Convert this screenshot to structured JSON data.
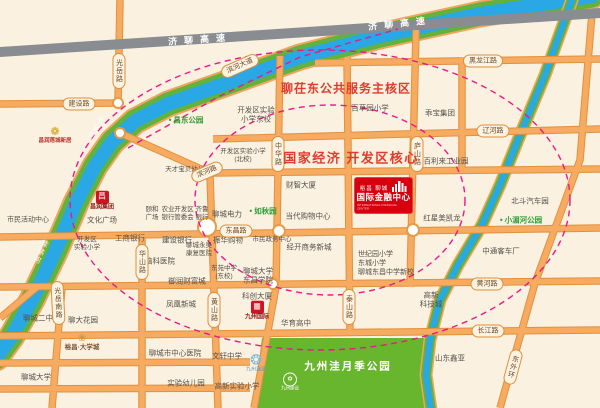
{
  "map": {
    "colors": {
      "background": "#faf1e0",
      "accent_red": "#e23a2c",
      "brand_red": "#d6000f",
      "road_orange": "#f6ab60",
      "river_blue": "#2aa7e5",
      "bank_green": "#62b23b",
      "park_green": "#68b52e",
      "dash_pink": "#ea1889",
      "highway_gray": "#898c90"
    },
    "highway_labels": [
      {
        "name": "jiliao-expressway-label-west",
        "text": "济聊高速",
        "x": 200,
        "y": 39,
        "r": -4
      },
      {
        "name": "jiliao-expressway-label-east",
        "text": "济聊高速",
        "x": 400,
        "y": 23,
        "r": -6
      }
    ],
    "zone_labels": [
      {
        "name": "zone-label-liaochidong",
        "text": "聊茌东公共服务主核区",
        "x": 346,
        "y": 88,
        "fs": 12,
        "ls": 1
      },
      {
        "name": "zone-label-kaifaqu-core",
        "text": "国家经济 开发区核心",
        "x": 351,
        "y": 157,
        "fs": 13,
        "ls": 1.5
      }
    ],
    "river_names": [
      {
        "name": "tuhai-river-label-1",
        "text": "徒骇河",
        "x": 95,
        "y": 128,
        "r": 30
      },
      {
        "name": "tuhai-river-label-2",
        "text": "徒骇河",
        "x": 40,
        "y": 252,
        "r": 25
      },
      {
        "name": "xiaomei-river-label",
        "text": "小湄河",
        "x": 452,
        "y": 248,
        "r": 26
      }
    ],
    "road_badges": [
      {
        "name": "badge-jianshe-road",
        "text": "建设路",
        "x": 79,
        "y": 104,
        "v": false,
        "r": 0
      },
      {
        "name": "badge-guangyue-road",
        "text": "光岳路",
        "x": 119,
        "y": 71,
        "v": true,
        "r": 0
      },
      {
        "name": "badge-binhe-avenue",
        "text": "滨河大道",
        "x": 240,
        "y": 66,
        "v": false,
        "r": -24
      },
      {
        "name": "badge-heilongjiang-road",
        "text": "黑龙江路",
        "x": 483,
        "y": 61,
        "v": false,
        "r": 0
      },
      {
        "name": "badge-liaohe-road",
        "text": "辽河路",
        "x": 493,
        "y": 131,
        "v": false,
        "r": 0
      },
      {
        "name": "badge-binhe-road",
        "text": "滨河路",
        "x": 207,
        "y": 172,
        "v": false,
        "r": -23
      },
      {
        "name": "badge-zhonghua-road",
        "text": "中华路",
        "x": 278,
        "y": 154,
        "v": true,
        "r": 0
      },
      {
        "name": "badge-lushan-road",
        "text": "庐山路",
        "x": 417,
        "y": 154,
        "v": true,
        "r": 0
      },
      {
        "name": "badge-dongchang-road",
        "text": "东昌路",
        "x": 236,
        "y": 231,
        "v": false,
        "r": 0
      },
      {
        "name": "badge-huashan-road",
        "text": "华山路",
        "x": 142,
        "y": 262,
        "v": true,
        "r": 0
      },
      {
        "name": "badge-huangshan-road",
        "text": "黄山路",
        "x": 214,
        "y": 310,
        "v": true,
        "r": 0
      },
      {
        "name": "badge-taishan-road",
        "text": "泰山路",
        "x": 349,
        "y": 307,
        "v": true,
        "r": 0
      },
      {
        "name": "badge-guangyue-south-road",
        "text": "光岳南路",
        "x": 58,
        "y": 303,
        "v": true,
        "r": -3
      },
      {
        "name": "badge-huanghe-road",
        "text": "黄河路",
        "x": 487,
        "y": 284,
        "v": false,
        "r": 0
      },
      {
        "name": "badge-changjiang-road",
        "text": "长江路",
        "x": 488,
        "y": 331,
        "v": false,
        "r": 0
      },
      {
        "name": "badge-dongwaihuan-road",
        "text": "东外环",
        "x": 513,
        "y": 367,
        "v": true,
        "r": 15
      }
    ],
    "green_pois": [
      {
        "name": "changdong-park-label",
        "text": "昌东公园",
        "x": 186,
        "y": 120
      },
      {
        "name": "ruqiu-garden-label",
        "text": "如秋园",
        "x": 263,
        "y": 211
      },
      {
        "name": "xiaomeihe-park-label",
        "text": "小湄河公园",
        "x": 521,
        "y": 220
      }
    ],
    "poi_labels": [
      {
        "name": "kaifaqu-exp-primary-east",
        "text": "开发区实验\n小学东校",
        "x": 256,
        "y": 115
      },
      {
        "name": "kaifaqu-exp-primary-north",
        "text": "开发区实验小学\n(北校)",
        "x": 243,
        "y": 156,
        "fs": 6.5
      },
      {
        "name": "tiancai-baby-kindergarten",
        "text": "天才宝贝幼儿园",
        "x": 188,
        "y": 170,
        "fs": 6.5
      },
      {
        "name": "baicaoyuan-primary",
        "text": "百草园小学",
        "x": 370,
        "y": 108
      },
      {
        "name": "guaibao-group",
        "text": "乖宝集团",
        "x": 440,
        "y": 113
      },
      {
        "name": "baililai-industrial-park",
        "text": "百利来工业园",
        "x": 446,
        "y": 161
      },
      {
        "name": "beidou-auto-park",
        "text": "北斗汽车园",
        "x": 530,
        "y": 201
      },
      {
        "name": "zhongtong-bus-factory",
        "text": "中通客车厂",
        "x": 501,
        "y": 251
      },
      {
        "name": "hongxing-meikailong",
        "text": "红星美凯龙",
        "x": 442,
        "y": 218
      },
      {
        "name": "caizhi-tower",
        "text": "财智大厦",
        "x": 301,
        "y": 185
      },
      {
        "name": "liaocheng-power",
        "text": "聊城电力",
        "x": 227,
        "y": 214
      },
      {
        "name": "dangdai-shopping-center",
        "text": "当代购物中心",
        "x": 308,
        "y": 216
      },
      {
        "name": "yihe-plaza",
        "text": "颐和\n广场",
        "x": 152,
        "y": 214,
        "fs": 6.5
      },
      {
        "name": "agricultural-bank",
        "text": "农业\n银行",
        "x": 168,
        "y": 214,
        "fs": 6.5
      },
      {
        "name": "kaifaqu-committee",
        "text": "开发区\n管委会",
        "x": 184,
        "y": 214,
        "fs": 6.5
      },
      {
        "name": "qilu-bank",
        "text": "齐鲁\n银行",
        "x": 202,
        "y": 214,
        "fs": 6.5
      },
      {
        "name": "icbc-bank",
        "text": "工商银行",
        "x": 130,
        "y": 238
      },
      {
        "name": "ccb-bank",
        "text": "建设银行",
        "x": 177,
        "y": 240
      },
      {
        "name": "zhenhua-shopping",
        "text": "振华购物",
        "x": 228,
        "y": 240
      },
      {
        "name": "civic-affairs-center",
        "text": "市民政务中心",
        "x": 272,
        "y": 240,
        "fs": 6.5
      },
      {
        "name": "jingkai-business-newtown",
        "text": "经开商务新城",
        "x": 309,
        "y": 247
      },
      {
        "name": "yongao-rehab-hospital",
        "text": "聊城永奥\n康复医院",
        "x": 199,
        "y": 250,
        "fs": 6.5
      },
      {
        "name": "naoke-hospital",
        "text": "脑科医院",
        "x": 160,
        "y": 261
      },
      {
        "name": "yurun-wealth-city",
        "text": "御润财富城",
        "x": 187,
        "y": 281
      },
      {
        "name": "fenghuang-new-town",
        "text": "凤凰新城",
        "x": 181,
        "y": 304
      },
      {
        "name": "dongyuan-middle-east-campus",
        "text": "东苑中学\n(东校)",
        "x": 224,
        "y": 273,
        "fs": 6.5
      },
      {
        "name": "liaocheng-univ-dongchang-college",
        "text": "聊城大学\n东昌学院",
        "x": 258,
        "y": 276
      },
      {
        "name": "east-schools-group",
        "text": "世纪园小学\n东城小学\n聊城东昌中学新校",
        "x": 358,
        "y": 264,
        "align": "left",
        "fs": 7
      },
      {
        "name": "gaoxin-tech-city",
        "text": "高新\n科技城",
        "x": 431,
        "y": 300
      },
      {
        "name": "shandong-xinya",
        "text": "山东鑫亚",
        "x": 450,
        "y": 358
      },
      {
        "name": "liaocheng-central-hospital",
        "text": "聊城市中心医院",
        "x": 175,
        "y": 353
      },
      {
        "name": "experimental-kindergarten",
        "text": "实验幼儿园",
        "x": 186,
        "y": 383
      },
      {
        "name": "wenxuan-middle-school",
        "text": "文轩中学",
        "x": 227,
        "y": 356
      },
      {
        "name": "gaoxin-exp-primary",
        "text": "高新实验小学",
        "x": 237,
        "y": 386
      },
      {
        "name": "huayu-high-school",
        "text": "华育高中",
        "x": 296,
        "y": 323
      },
      {
        "name": "kechuang-tower",
        "text": "科创大厦",
        "x": 257,
        "y": 296
      },
      {
        "name": "liaocheng-no2-middle",
        "text": "聊城二中",
        "x": 38,
        "y": 318
      },
      {
        "name": "liaoda-garden",
        "text": "聊大花园",
        "x": 83,
        "y": 320
      },
      {
        "name": "liaocheng-university",
        "text": "聊城大学",
        "x": 36,
        "y": 377
      },
      {
        "name": "citizen-activity-center",
        "text": "市民活动中心",
        "x": 28,
        "y": 221,
        "fs": 7
      },
      {
        "name": "culture-square",
        "text": "文化广场",
        "x": 102,
        "y": 220
      },
      {
        "name": "kaifaqu-exp-primary-west",
        "text": "开发区\n实验小学",
        "x": 87,
        "y": 244,
        "fs": 6.5
      }
    ],
    "logos": [
      {
        "type": "lotus",
        "name": "liancheng-xinju-logo",
        "x": 55,
        "y": 135,
        "icon": "❁",
        "text": "昌润莲城新居"
      },
      {
        "type": "redbox",
        "name": "changrun-group-logo",
        "x": 102,
        "y": 201,
        "glyph": "昌",
        "text": "昌润集团"
      },
      {
        "type": "ornate",
        "name": "yuchang-daxuecheng-logo",
        "x": 82,
        "y": 342,
        "icon": "❀",
        "text": "裕昌·大学城"
      },
      {
        "type": "redbox",
        "name": "jiuzhou-intl-logo",
        "x": 257,
        "y": 311,
        "glyph": "▦",
        "text": "九州国际"
      },
      {
        "type": "blue",
        "name": "jiuzhou-wenquan-logo",
        "x": 256,
        "y": 363,
        "icon": "❂",
        "text": "九州温泉"
      },
      {
        "type": "ring",
        "name": "park-brand-logo",
        "x": 290,
        "y": 382,
        "glyph": "✿",
        "text": "九州建设"
      }
    ],
    "ifc": {
      "line1": "裕昌 聊城",
      "line2": "国际金融中心",
      "line3": "INTERNATIONAL FINANCIAL CENTER"
    },
    "park": {
      "name": "九州洼月季公园"
    }
  }
}
